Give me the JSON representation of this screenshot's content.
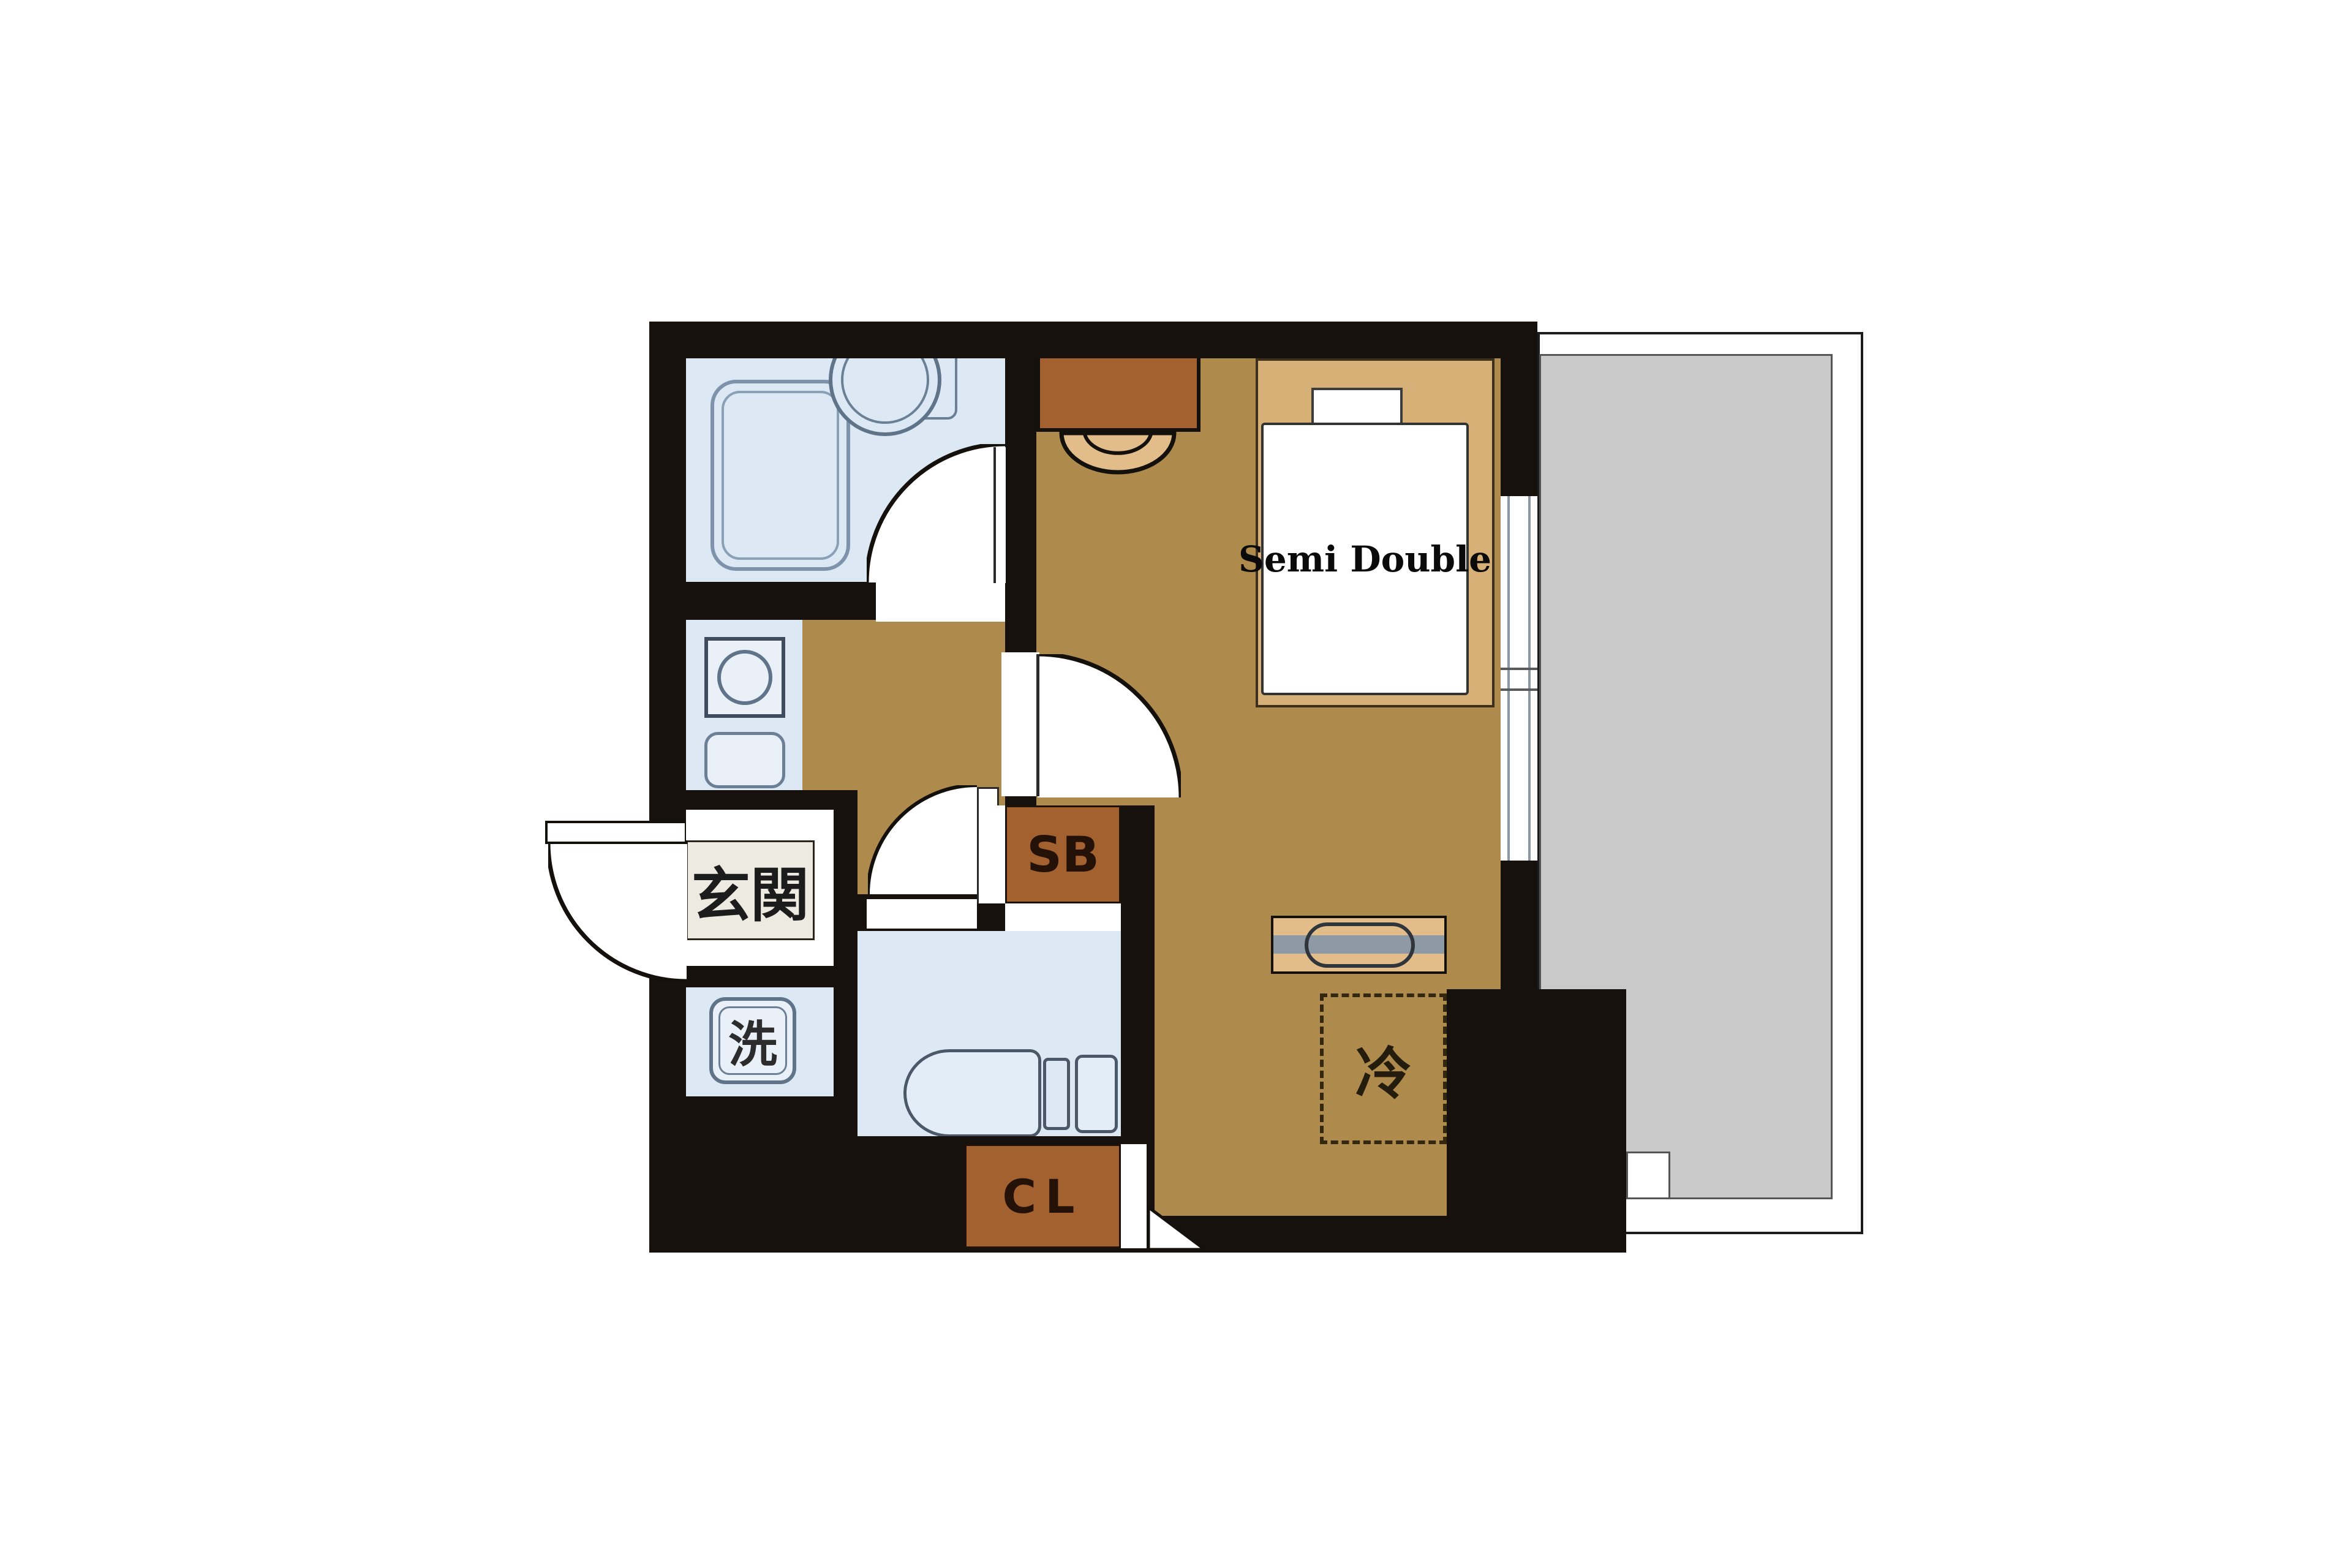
{
  "floorplan": {
    "labels": {
      "entrance": "玄関",
      "laundry": "洗",
      "shoe_box": "SB",
      "closet": "CL",
      "refrigerator": "冷",
      "bed": "Semi Double"
    },
    "palette": {
      "wall": "#17110d",
      "floor": "#ae8b4d",
      "wet": "#dce8f3",
      "fix": "#e9f0f8",
      "stroke": "#6b8097",
      "wood-dark": "#a2612e",
      "wood-light": "#e2bd8a",
      "bed": "#d7b077",
      "entr": "#edeae1",
      "balc": "#c9c9c9",
      "graybar": "#8d99a5",
      "ink": "#14100c"
    }
  }
}
